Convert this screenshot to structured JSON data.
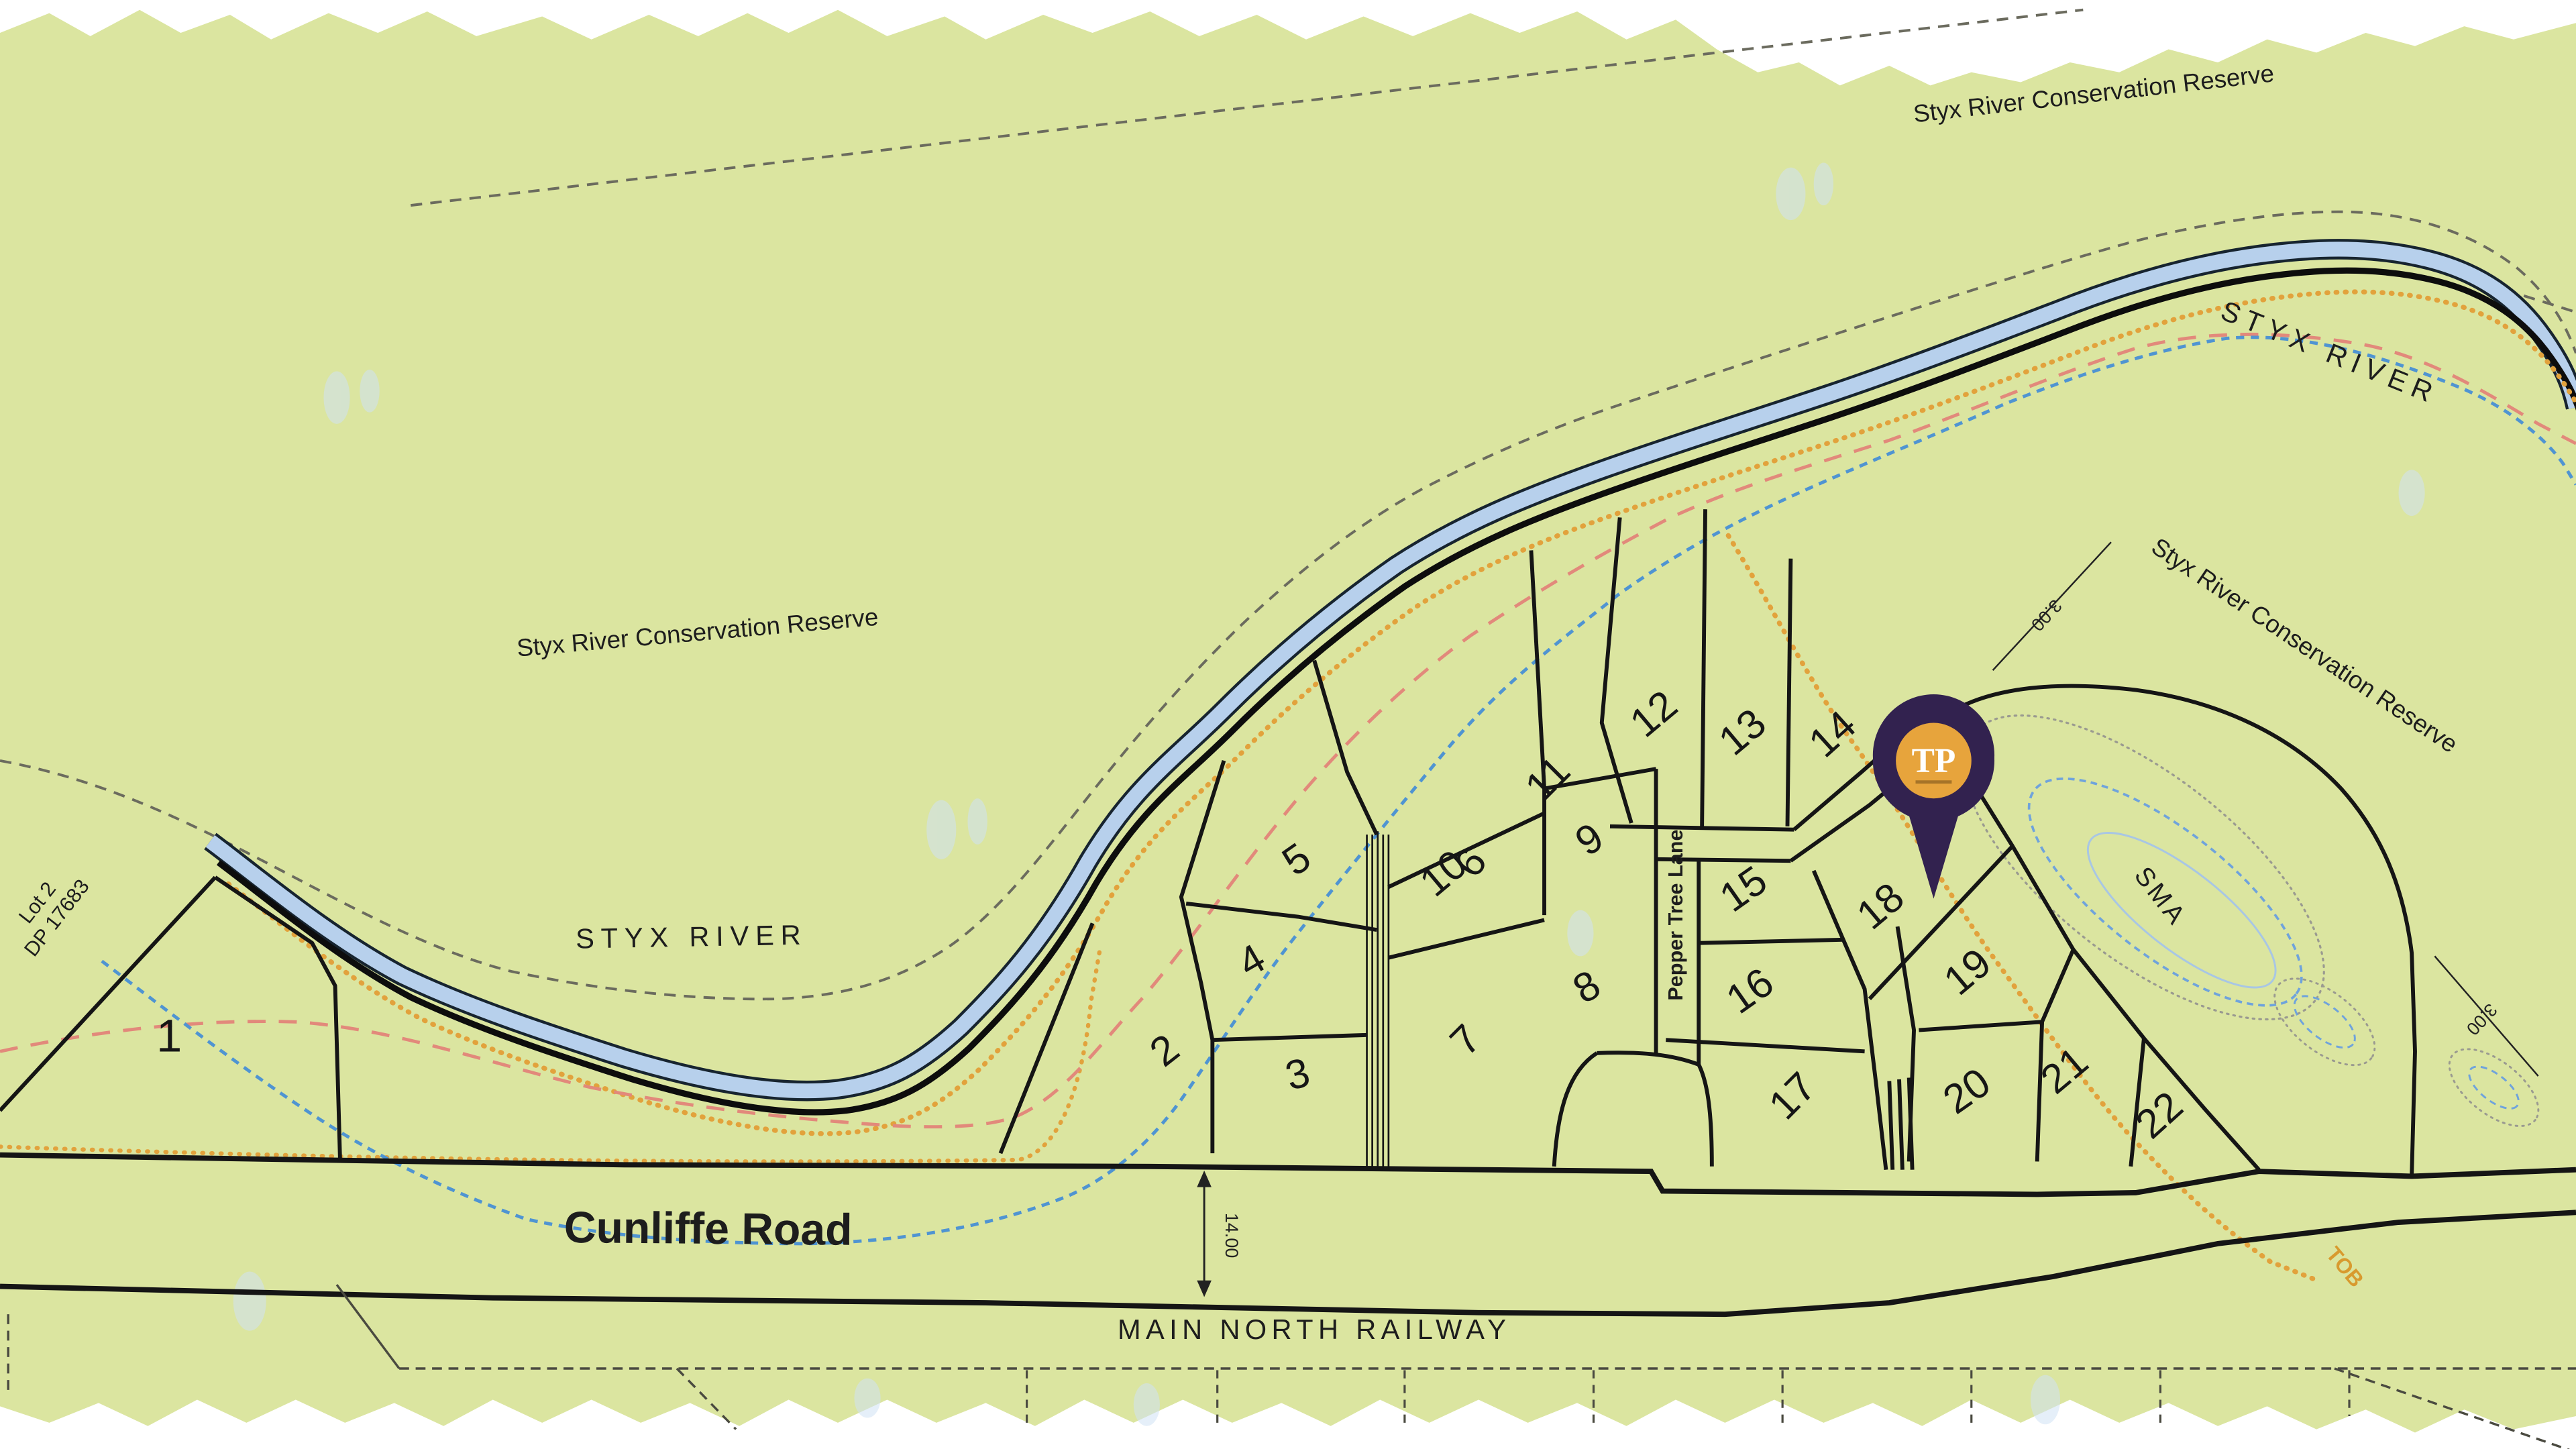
{
  "map": {
    "title": "Subdivision plan - Cunliffe Road / Styx River",
    "labels": {
      "reserve_top": "Styx River Conservation Reserve",
      "reserve_left": "Styx River Conservation Reserve",
      "reserve_right": "Styx River Conservation Reserve",
      "styx_river_left": "STYX RIVER",
      "styx_river_right": "STYX RIVER",
      "cunliffe_road": "Cunliffe Road",
      "main_north_railway": "MAIN NORTH RAILWAY",
      "pepper_tree_lane": "Pepper Tree Lane",
      "sma": "SMA",
      "tob": "TOB",
      "lot2_dp_line1": "Lot 2",
      "lot2_dp_line2": "DP 17683",
      "dim_road_width": "14.00",
      "dim_3a": "3.00",
      "dim_3b": "3.00"
    },
    "lots": [
      "1",
      "2",
      "3",
      "4",
      "5",
      "6",
      "7",
      "8",
      "9",
      "10",
      "11",
      "12",
      "13",
      "14",
      "15",
      "16",
      "17",
      "18",
      "19",
      "20",
      "21",
      "22"
    ],
    "pin": {
      "label": "TP"
    },
    "colors": {
      "paper_green": "#dbe5a0",
      "river_water": "#b7d0ec",
      "river_bank": "#17242f",
      "boundary_black": "#141414",
      "orange_tob": "#e2a23c",
      "red_dashed": "#e2897b",
      "blue_dashed": "#4f94d2",
      "gray_dashed": "#6b6b5e",
      "pin_purple": "#32224f",
      "pin_gold": "#e7a43c"
    }
  }
}
